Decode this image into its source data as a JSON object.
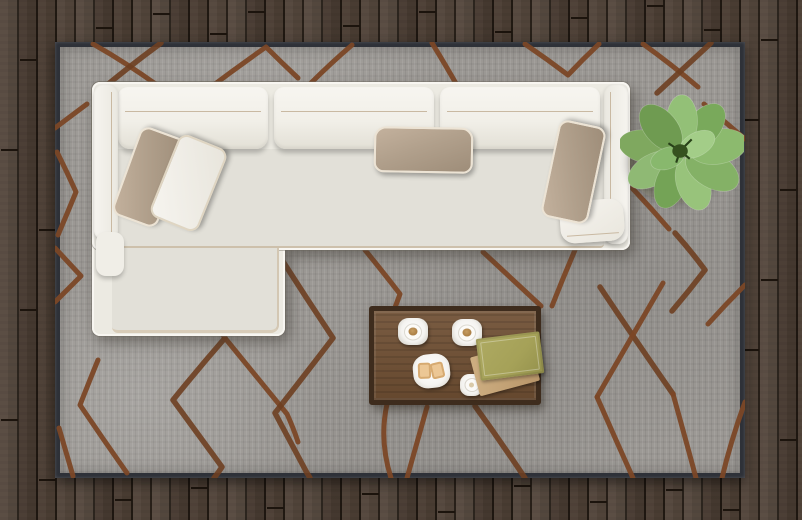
{
  "scene": {
    "title": "Top view of a modern living room",
    "view": "top-down",
    "room": "living room with dark hardwood floor"
  },
  "palette": {
    "floor-wood": "#52443a",
    "floor-gap": "#211912",
    "rug-base": "#9c9995",
    "rug-edge": "#2e3138",
    "rug-pattern": "#7b4726",
    "sofa-fabric": "#eceae2",
    "sofa-seat": "#e2e0d8",
    "piping": "#c9b9a2",
    "pillow-taupe": "#b3a08c",
    "pillow-white": "#f0eee7",
    "plant-leaf": "#84ad66",
    "table-wood": "#6e4e32",
    "table-edge": "#3e2c1d",
    "book-top": "#a5a158",
    "book-bottom": "#c2a277",
    "coffee": "#b5854e",
    "toast": "#ecc795"
  },
  "objects": {
    "floor": {
      "label": "dark wood plank floor",
      "plank_orientation": "vertical"
    },
    "rug": {
      "label": "gray area rug with brown hand-drawn diamond lattice pattern",
      "border": "dark edge"
    },
    "sofa": {
      "label": "white L-shaped sectional sofa with chaise on the left",
      "back_cushions": 3,
      "throw_pillows": [
        {
          "label": "taupe pillow on chaise"
        },
        {
          "label": "white pillow on chaise"
        },
        {
          "label": "taupe pillow center backrest"
        },
        {
          "label": "taupe pillow right armrest"
        }
      ]
    },
    "plant": {
      "label": "potted green plant seen from above",
      "leaf_count": 11
    },
    "coffee_table": {
      "label": "rectangular wooden coffee table",
      "items": [
        "coffee cup on square saucer",
        "coffee cup on square saucer",
        "square plate with two toasts",
        "small white cup",
        "two stacked books (olive green over tan)"
      ]
    }
  }
}
